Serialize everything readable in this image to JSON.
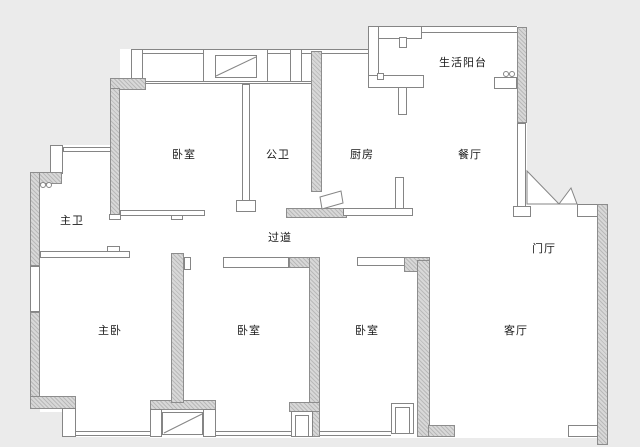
{
  "palette": {
    "background": "#ebebeb",
    "floor": "#ffffff",
    "wall_line": "#858585",
    "wall_fill": "#d8d8d8",
    "text": "#1a1a1a"
  },
  "rooms": {
    "balcony": "生活阳台",
    "bedroom_top": "卧室",
    "public_bath": "公卫",
    "kitchen": "厨房",
    "dining": "餐厅",
    "master_bath": "主卫",
    "corridor": "过道",
    "foyer": "门厅",
    "master_bedroom": "主卧",
    "bedroom_mid": "卧室",
    "bedroom_right": "卧室",
    "living": "客厅"
  }
}
